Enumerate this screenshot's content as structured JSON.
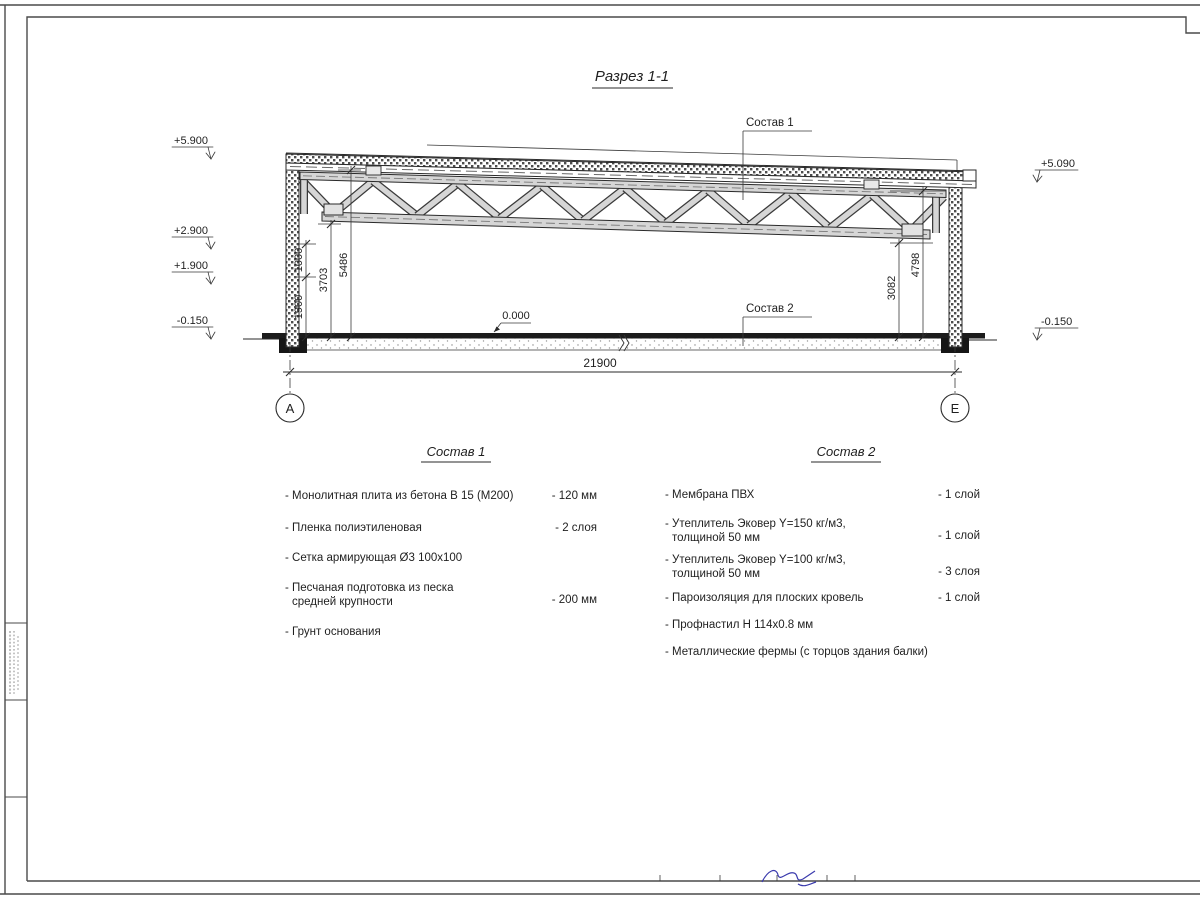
{
  "sheet": {
    "title": "Разрез 1-1"
  },
  "section": {
    "label_sostav1": "Состав 1",
    "label_sostav2": "Состав 2",
    "zero_level": "0.000",
    "elev_left": {
      "e1": "+5.900",
      "e2": "+2.900",
      "e3": "+1.900",
      "e4": "-0.150"
    },
    "elev_right": {
      "e1": "+5.090",
      "e2": "-0.150"
    },
    "dims": {
      "d1900": "1900",
      "d1000": "1000",
      "d3703": "3703",
      "d5486": "5486",
      "d3082": "3082",
      "d4798": "4798",
      "span": "21900"
    },
    "axes": {
      "left": "А",
      "right": "Е"
    }
  },
  "sostav1": {
    "heading": "Состав 1",
    "items": [
      {
        "line1": "- Монолитная плита из бетона В 15 (М200)",
        "value": "- 120 мм"
      },
      {
        "line1": "- Пленка полиэтиленовая",
        "value": "- 2 слоя"
      },
      {
        "line1": "- Сетка армирующая Ø3 100х100",
        "value": ""
      },
      {
        "line1": "- Песчаная подготовка из песка",
        "line2": "средней крупности",
        "value": "- 200 мм"
      },
      {
        "line1": "- Грунт основания",
        "value": ""
      }
    ]
  },
  "sostav2": {
    "heading": "Состав 2",
    "items": [
      {
        "line1": "- Мембрана ПВХ",
        "value": "- 1 слой"
      },
      {
        "line1": "- Утеплитель Эковер Y=150 кг/м3,",
        "line2": "толщиной 50 мм",
        "value": "- 1 слой"
      },
      {
        "line1": "- Утеплитель Эковер Y=100 кг/м3,",
        "line2": "толщиной 50 мм",
        "value": "- 3 слоя"
      },
      {
        "line1": "- Пароизоляция для плоских кровель",
        "value": "- 1 слой"
      },
      {
        "line1": "- Профнастил Н 114х0.8 мм",
        "value": ""
      },
      {
        "line1": "- Металлические фермы (с торцов здания балки)",
        "value": ""
      }
    ]
  }
}
